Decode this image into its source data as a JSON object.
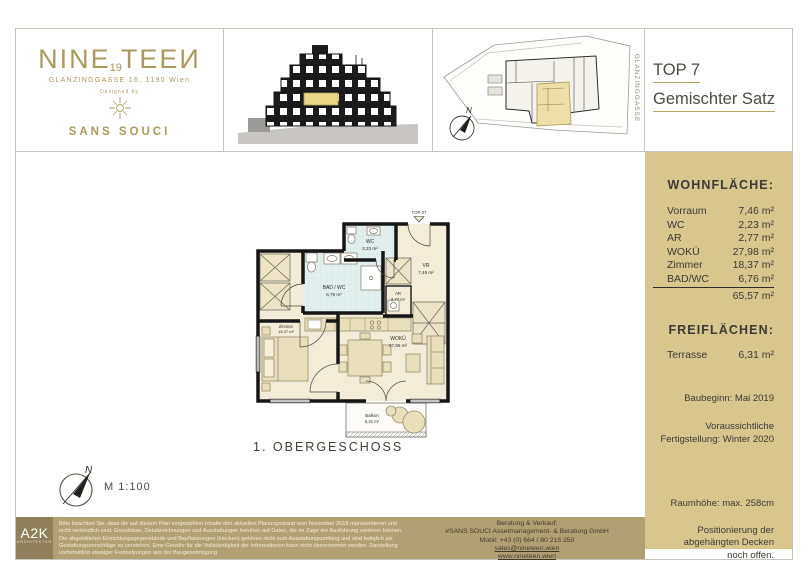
{
  "brand": {
    "name_part1": "NINE",
    "name_number": "19",
    "name_part2": "TEEИ",
    "address": "GLANZINGGASSE 16, 1190 Wien",
    "designed_by": "Designed by",
    "designer": "SANS SOUCI"
  },
  "header": {
    "unit_title": "TOP 7",
    "unit_subtitle": "Gemischter Satz"
  },
  "site_plan": {
    "street": "GLANZINGGASSE",
    "north": "N"
  },
  "sidebar": {
    "living_area_heading": "WOHNFLÄCHE:",
    "rooms": [
      {
        "label": "Vorraum",
        "area": "7,46 m²"
      },
      {
        "label": "WC",
        "area": "2,23 m²"
      },
      {
        "label": "AR",
        "area": "2,77 m²"
      },
      {
        "label": "WOKÜ",
        "area": "27,98 m²"
      },
      {
        "label": "Zimmer",
        "area": "18,37 m²"
      },
      {
        "label": "BAD/WC",
        "area": "6,76 m²"
      }
    ],
    "total": "65,57 m²",
    "outdoor_heading": "FREIFLÄCHEN:",
    "outdoor_rooms": [
      {
        "label": "Terrasse",
        "area": "6,31 m²"
      }
    ],
    "construction_start": "Baubeginn: Mai 2019",
    "completion_line1": "Voraussichtliche",
    "completion_line2": "Fertigstellung: Winter 2020",
    "room_height": "Raumhöhe: max. 258cm",
    "ceiling_note": "Positionierung der abgehängten Decken noch offen."
  },
  "plan": {
    "unit_label": "TOP 07",
    "floor_label": "1. OBERGESCHOSS",
    "scale_label": "M 1:100",
    "north": "N",
    "rooms": {
      "wc": {
        "name": "WC",
        "area": "2,23 m²"
      },
      "bad_wc": {
        "name": "BAD / WC",
        "area": "6,76 m²"
      },
      "vr": {
        "name": "VR",
        "area": "7,46 m²"
      },
      "ar": {
        "name": "AR",
        "area": "2,77 m²"
      },
      "wokue": {
        "name": "WOKÜ",
        "area": "27,98 m²"
      },
      "zimmer": {
        "name": "Zimmer",
        "area": "18,37 m²"
      },
      "balkon": {
        "name": "Balkon",
        "area": "6,31 m²"
      }
    }
  },
  "footer": {
    "architect_logo": "A2K",
    "architect_sub": "ARCHITEKTEN",
    "disclaimer": "Bitte beachten Sie, dass die auf diesem Plan vorgestellten Inhalte den aktuellen Planungsstand vom November 2018 repräsentieren und nicht verbindlich sind. Grundrisse, Detailzeichnungen und Ausstattungen beruhen auf Daten, die im Zuge der Ausführung variieren können. Die abgebildeten Einrichtungsgegenstände und Bepflanzungen (Hecken) gehören nicht zum Ausstattungsumfang und sind lediglich als Gestaltungsvorschläge zu verstehen. Eine Gewähr für die Vollständigkeit der Informationen kann nicht übernommen werden. Darstellung vorbehaltlich etwaiger Festsetzungen aus der Baugenehmigung",
    "contact_heading": "Beratung & Verkauf:",
    "contact_company": "#SANS SOUCI Assetmanagement- & Beratung GmbH",
    "contact_mobile": "Mobil: +43 (0) 664 / 80 215 250",
    "contact_email": "sales@nineteen.wien",
    "contact_web": "www.nineteen.wien"
  },
  "colors": {
    "gold_accent": "#ac9a5c",
    "sidebar_bg": "#d7c78d",
    "footer_bg": "#b1a172",
    "architect_box_bg": "#90805a",
    "highlight_unit": "#ecdfa8",
    "bath_tile": "#e2efee",
    "floor": "#f2ecd8"
  }
}
